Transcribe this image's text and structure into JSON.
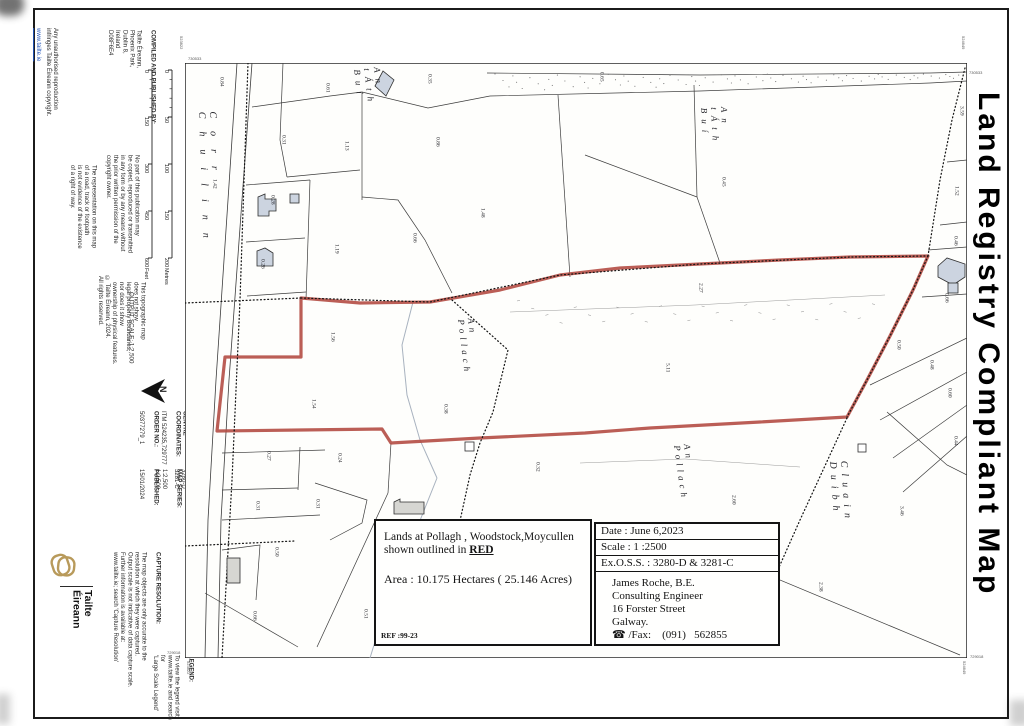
{
  "page": {
    "right_title": "Land Registry Compliant Map"
  },
  "sidebar": {
    "link": "www.tailte.ie",
    "unauthorised": [
      "Any unauthorised reproduction",
      "infringes Tailte Éireann copyright."
    ],
    "compiled": {
      "head": "COMPILED AND PUBLISHED BY:",
      "lines": [
        "Tailte Éireann,",
        "Phoenix Park,",
        "Dublin 8,",
        "Ireland",
        "D08F6E4"
      ]
    },
    "no_part": [
      "No part of this publication may",
      "be copied, reproduced or transmitted",
      "in any form or by any means without",
      "the prior written permission of the",
      "copyright owner."
    ],
    "representation": [
      "The representation on this map",
      "of a road, track or footpath",
      "is not evidence of the existence",
      "of a right of way."
    ],
    "copyright": [
      "© Tailte Éireann, 2024.",
      "All rights reserved."
    ],
    "topographic": [
      "This topographic map",
      "does not show",
      "legal property boundaries,",
      "nor does it show",
      "ownership of physical features."
    ],
    "output_scale": "OUTPUT SCALE: 1:2,500",
    "scale_metres": {
      "ticks": [
        "0",
        "50",
        "100",
        "150",
        "200"
      ],
      "unit": "Metres"
    },
    "scale_feet": {
      "ticks": [
        "0",
        "150",
        "300",
        "450",
        "600"
      ],
      "unit": "Feet"
    },
    "north": "N",
    "centre": {
      "head": [
        "CENTRE",
        "COORDINATES:"
      ],
      "lines": [
        "ITM 524235,729777"
      ]
    },
    "order": {
      "head": [
        "ORDER NO.:"
      ],
      "lines": [
        "50377279_1"
      ]
    },
    "published": {
      "head": [
        "PUBLISHED:"
      ],
      "lines": [
        "15/01/2024"
      ]
    },
    "map_series": {
      "head": [
        "MAP SERIES:"
      ],
      "lines": [
        "1:2,500",
        "1:2,500"
      ]
    },
    "map_sheets": {
      "head": [
        "MAP SHEETS:"
      ],
      "lines": [
        "3280-D",
        "3281-C"
      ]
    },
    "capture": {
      "head": [
        "CAPTURE RESOLUTION:"
      ],
      "lines": [
        "The map objects are only accurate to the",
        "resolution at which they were captured.",
        "Output scale is not indicative of data capture scale.",
        "Further information is available at:",
        "www.tailte.ie; search 'Capture Resolution'"
      ]
    },
    "legend": {
      "head": [
        "LEGEND:"
      ],
      "lines": [
        "To view the legend visit",
        "www.tailte.ie and search for",
        "'Large Scale Legend'"
      ]
    },
    "brand": [
      "Tailte",
      "Éireann"
    ]
  },
  "map": {
    "corner_labels": {
      "tl_v": "523822",
      "tl_h": "730533",
      "tr_v": "524649",
      "tr_h": "730533",
      "bl_v": "523822",
      "bl_h": "729018",
      "br_v": "524649",
      "br_h": "729018"
    },
    "placenames": [
      {
        "text": "Corr Chuilinn",
        "x": 196,
        "y": 112,
        "ls": 13,
        "size": 10,
        "rot": -2
      },
      {
        "text": "An tÁth Buí",
        "x": 352,
        "y": 70,
        "ls": 6,
        "size": 9,
        "rot": -7
      },
      {
        "text": "An tÁth Buí",
        "x": 699,
        "y": 108,
        "ls": 6,
        "size": 9,
        "rot": -3
      },
      {
        "text": "An Pollach",
        "x": 456,
        "y": 320,
        "ls": 4,
        "size": 9,
        "rot": -7
      },
      {
        "text": "An Pollach",
        "x": 672,
        "y": 446,
        "ls": 4,
        "size": 9,
        "rot": -8
      },
      {
        "text": "Cluain Duibh",
        "x": 827,
        "y": 462,
        "ls": 6,
        "size": 10,
        "rot": -4
      }
    ],
    "parcel_labels": [
      {
        "v": "0.84",
        "x": 221,
        "y": 86
      },
      {
        "v": "0.61",
        "x": 327,
        "y": 92
      },
      {
        "v": "0.35",
        "x": 429,
        "y": 83
      },
      {
        "v": "0.65",
        "x": 601,
        "y": 81
      },
      {
        "v": "1.42",
        "x": 214,
        "y": 188
      },
      {
        "v": "0.31",
        "x": 283,
        "y": 144
      },
      {
        "v": "1.13",
        "x": 346,
        "y": 150
      },
      {
        "v": "0.86",
        "x": 437,
        "y": 146
      },
      {
        "v": "0.28",
        "x": 272,
        "y": 204
      },
      {
        "v": "0.26",
        "x": 262,
        "y": 268
      },
      {
        "v": "1.19",
        "x": 336,
        "y": 253
      },
      {
        "v": "0.66",
        "x": 414,
        "y": 242
      },
      {
        "v": "1.48",
        "x": 482,
        "y": 217
      },
      {
        "v": "0.45",
        "x": 723,
        "y": 186
      },
      {
        "v": "2.27",
        "x": 700,
        "y": 292
      },
      {
        "v": "5.11",
        "x": 667,
        "y": 372
      },
      {
        "v": "1.56",
        "x": 332,
        "y": 341
      },
      {
        "v": "1.54",
        "x": 313,
        "y": 408
      },
      {
        "v": "0.38",
        "x": 445,
        "y": 413
      },
      {
        "v": "0.27",
        "x": 268,
        "y": 460
      },
      {
        "v": "0.24",
        "x": 339,
        "y": 462
      },
      {
        "v": "0.31",
        "x": 257,
        "y": 510
      },
      {
        "v": "0.31",
        "x": 317,
        "y": 508
      },
      {
        "v": "0.50",
        "x": 276,
        "y": 556
      },
      {
        "v": "0.32",
        "x": 537,
        "y": 471
      },
      {
        "v": "0.66",
        "x": 254,
        "y": 620
      },
      {
        "v": "0.51",
        "x": 365,
        "y": 618
      },
      {
        "v": "2.60",
        "x": 733,
        "y": 504
      },
      {
        "v": "3.46",
        "x": 901,
        "y": 515
      },
      {
        "v": "2.38",
        "x": 820,
        "y": 591
      },
      {
        "v": "0.60",
        "x": 949,
        "y": 397
      },
      {
        "v": "0.44",
        "x": 955,
        "y": 445
      },
      {
        "v": "3.59",
        "x": 961,
        "y": 115
      },
      {
        "v": "1.52",
        "x": 956,
        "y": 195
      },
      {
        "v": "0.46",
        "x": 955,
        "y": 245
      },
      {
        "v": "0.66",
        "x": 946,
        "y": 302
      },
      {
        "v": "0.50",
        "x": 898,
        "y": 349
      },
      {
        "v": "0.48",
        "x": 931,
        "y": 369
      }
    ]
  },
  "boxes": {
    "description": {
      "line1": "Lands at Pollagh , Woodstock,Moycullen",
      "line2_prefix": "shown outlined in ",
      "line2_red": "RED",
      "area": "Area : 10.175 Hectares ( 25.146 Acres)",
      "ref": "REF :99-23"
    },
    "details": {
      "date": "Date : June 6,2023",
      "scale": "Scale : 1 :2500",
      "exoss": "Ex.O.S.S. : 3280-D & 3281-C",
      "contact": [
        "James Roche, B.E.",
        "Consulting Engineer",
        "16 Forster Street",
        "Galway.",
        "☎ /Fax:    (091)   562855"
      ]
    }
  },
  "colors": {
    "boundary_red": "#b2483f",
    "link_blue": "#2255bb",
    "logo_gold": "#b89a5b"
  }
}
